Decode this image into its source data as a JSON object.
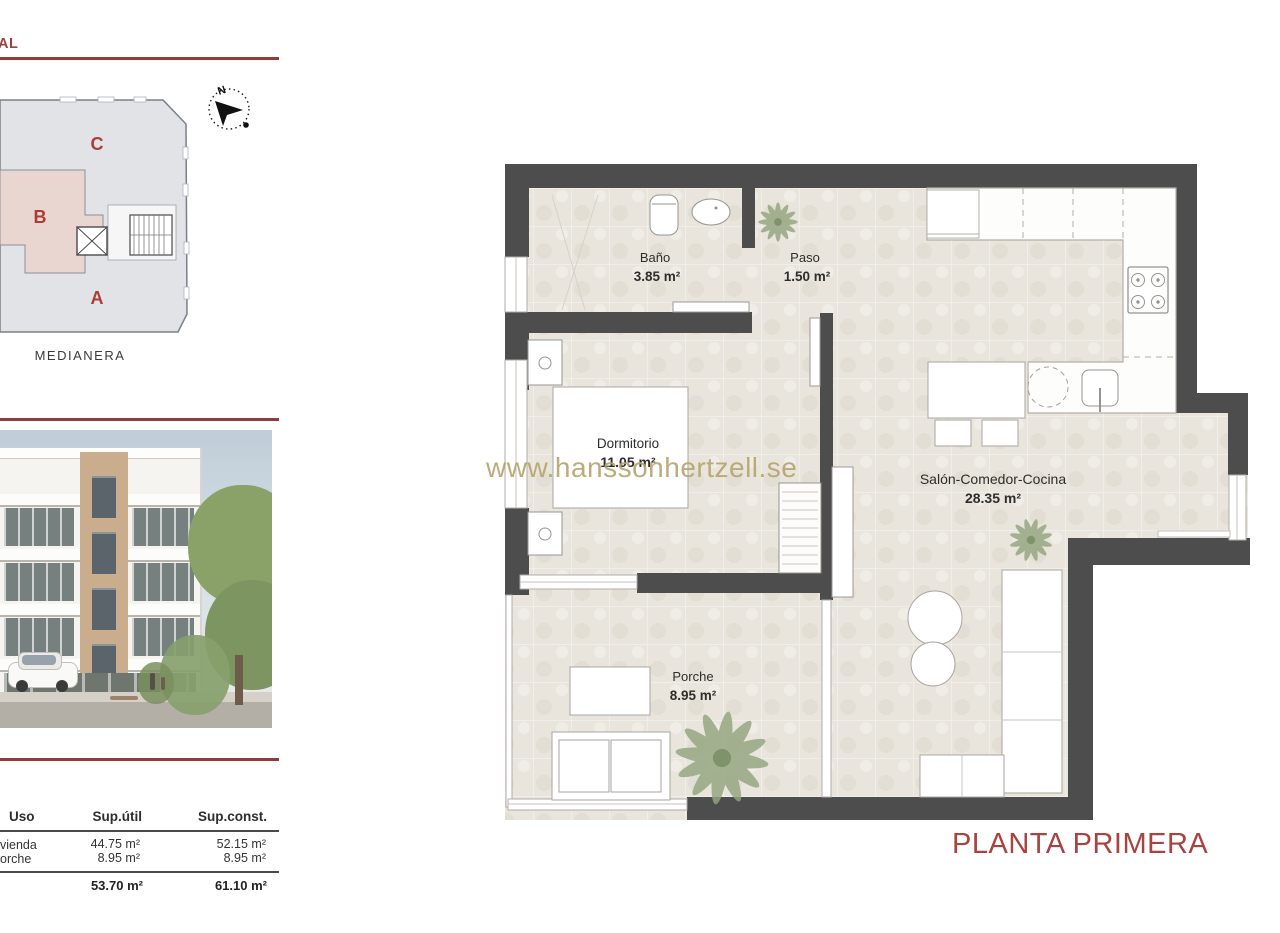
{
  "header": {
    "clipped_title": "RAL"
  },
  "site_plan": {
    "label_c": "C",
    "label_b": "B",
    "label_a": "A",
    "medianera": "MEDIANERA",
    "compass_north": "N"
  },
  "areas_table": {
    "headers": {
      "uso": "Uso",
      "sup_util": "Sup.útil",
      "sup_const": "Sup.const."
    },
    "rows": [
      {
        "uso": "vienda",
        "sup_util": "44.75 m²",
        "sup_const": "52.15 m²"
      },
      {
        "uso": "orche",
        "sup_util": "8.95 m²",
        "sup_const": "8.95 m²"
      }
    ],
    "totals": {
      "sup_util": "53.70 m²",
      "sup_const": "61.10 m²"
    }
  },
  "floor_plan": {
    "watermark": "www.hanssonhertzell.se",
    "title": "PLANTA PRIMERA",
    "rooms": {
      "bano": {
        "name": "Baño",
        "area": "3.85 m²"
      },
      "paso": {
        "name": "Paso",
        "area": "1.50 m²"
      },
      "dormitorio": {
        "name": "Dormitorio",
        "area": "11.05 m²"
      },
      "salon": {
        "name": "Salón-Comedor-Cocina",
        "area": "28.35 m²"
      },
      "porche": {
        "name": "Porche",
        "area": "8.95 m²"
      }
    }
  },
  "colors": {
    "accent_red": "#8f3c3a",
    "title_red": "#a8433f",
    "wall_gray": "#4e4d4e",
    "floor_beige": "#e9e5dc",
    "watermark_gold": "#b5a46e",
    "site_pink": "#e9d6d1",
    "site_gray": "#e2e3e6"
  }
}
